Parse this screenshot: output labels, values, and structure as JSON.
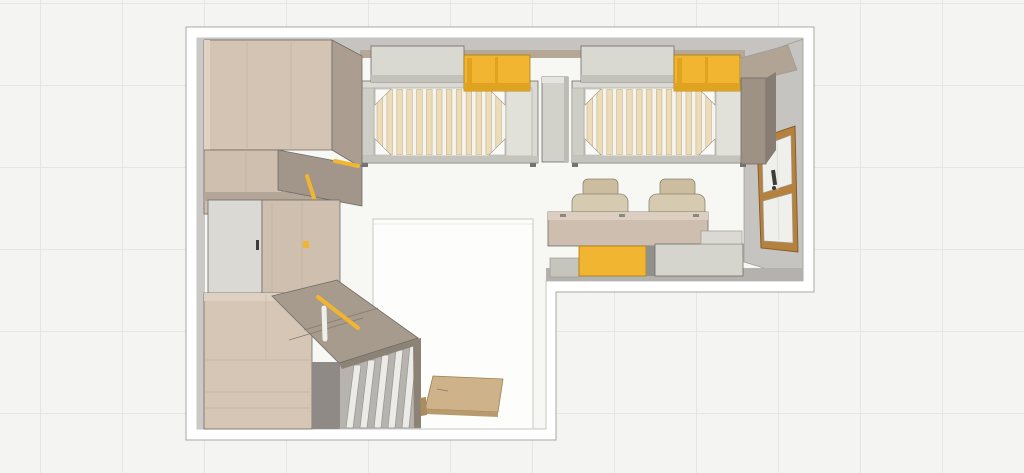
{
  "view": {
    "description": "Top-down 3D rendering of an L-shaped children's bedroom with two slatted beds, double desk, wardrobes and sloped storage"
  },
  "palette": {
    "bg": "#f4f4f2",
    "grid": "#e5e5e3",
    "wallCut": "#ffffff",
    "wallOutline": "#a9a7a4",
    "floor": "#f7f7f4",
    "floorEdge": "#c6c4c1",
    "wallFace": "#c6c4c1",
    "wallFaceDark": "#b4b2af",
    "wallSide": "#cbc9c6",
    "shelf": "#b6a896",
    "rug": "#fdfdfb",
    "rugEdge": "#d2d0cd",
    "winWood": "#b5813c",
    "winEdge": "#7e5a28",
    "glass": "#efefec",
    "handle": "#3e3c39",
    "woodA": "#d4c4b3",
    "woodHi": "#e1d3c3",
    "woodC": "#cfbfae",
    "grain": "#bfae9b",
    "taupeB": "#ab9e90",
    "gStrip": "#b3a698",
    "flap": "#a2968a",
    "door": "#dad9d3",
    "platform": "#d5c6b5",
    "woodTopBand": "#dfd1c1",
    "opening": "#8f8a85",
    "finBack": "#b7b4af",
    "finWhite": "#edebe7",
    "finEdge": "#96948e",
    "slope": "#a79b8d",
    "slopeBand": "#8d8276",
    "slopeLine": "#857a6e",
    "yellow": "#f2b531",
    "yellowDark": "#dfa31f",
    "yellowEdge": "#a87c12",
    "bedFrame": "#dbdad2",
    "slatBg": "#f6f4ef",
    "slat": "#ecdcb7",
    "slatEdge": "#bca87e",
    "wedge": "#fbfaf6",
    "railL": "#cfcec6",
    "railR": "#e2e1d9",
    "bedShadow": "#c4c3bc",
    "foot": "#76746f",
    "pillow": "#d9d8d1",
    "pillowShadow": "#c2c1ba",
    "column": "#d2d1ca",
    "columnLight": "#e5e4de",
    "columnShade": "#bcbbb4",
    "endTop": "#b1a495",
    "endFront": "#9e9285",
    "endSide": "#877d72",
    "deskWood": "#cdbeb0",
    "deskBand": "#dccfc2",
    "chair": "#d6cab0",
    "chairDark": "#cbbd9e",
    "chairEdge": "#8d8470",
    "drawerGray": "#d6d5cd",
    "drawerDivider": "#91908a",
    "plinth": "#c5c4bd",
    "sideStep": "#dad9d2",
    "hinge": "#8a887f",
    "outline": "#6e6c68",
    "outlineSoft": "#9c9a97",
    "boardTan": "#ceb28a",
    "boardFront": "#b99a6e",
    "boardFoot": "#a98c62",
    "boardEdge": "#9d7f52",
    "white": "#f0efec"
  },
  "objects": [
    {
      "name": "bed-1",
      "label": "Bed 1 with slatted base, pillow and yellow storage box"
    },
    {
      "name": "bed-2",
      "label": "Bed 2 with slatted base, pillow and yellow storage box"
    },
    {
      "name": "nightstand-column",
      "label": "Divider column between beds"
    },
    {
      "name": "wall-shelf",
      "label": "Wall shelf behind bed heads"
    },
    {
      "name": "bed-end-cabinet",
      "label": "Tall cabinet at foot of bed 2"
    },
    {
      "name": "window",
      "label": "Wood-framed window in right wall"
    },
    {
      "name": "desk",
      "label": "Double desk"
    },
    {
      "name": "desk-chair-1",
      "label": "Desk chair 1"
    },
    {
      "name": "desk-chair-2",
      "label": "Desk chair 2"
    },
    {
      "name": "yellow-drawer-unit",
      "label": "Yellow under-desk drawer unit"
    },
    {
      "name": "gray-drawer-unit",
      "label": "Gray under-desk drawer unit"
    },
    {
      "name": "tall-wardrobe",
      "label": "Tall corner wardrobe"
    },
    {
      "name": "wardrobe-flap",
      "label": "Open wardrobe flap with yellow handles"
    },
    {
      "name": "wardrobe-door-unit",
      "label": "Wardrobe with hinged door"
    },
    {
      "name": "storage-platform",
      "label": "Low wooden storage platform"
    },
    {
      "name": "sloped-cabinet",
      "label": "Sloped storage cabinet top"
    },
    {
      "name": "slat-screen",
      "label": "Vertical white slat screen"
    },
    {
      "name": "floor-board",
      "label": "Wooden board on floor"
    },
    {
      "name": "play-rug",
      "label": "White play rug"
    },
    {
      "name": "room-walls",
      "label": "L-shaped room walls (section cut)"
    }
  ]
}
